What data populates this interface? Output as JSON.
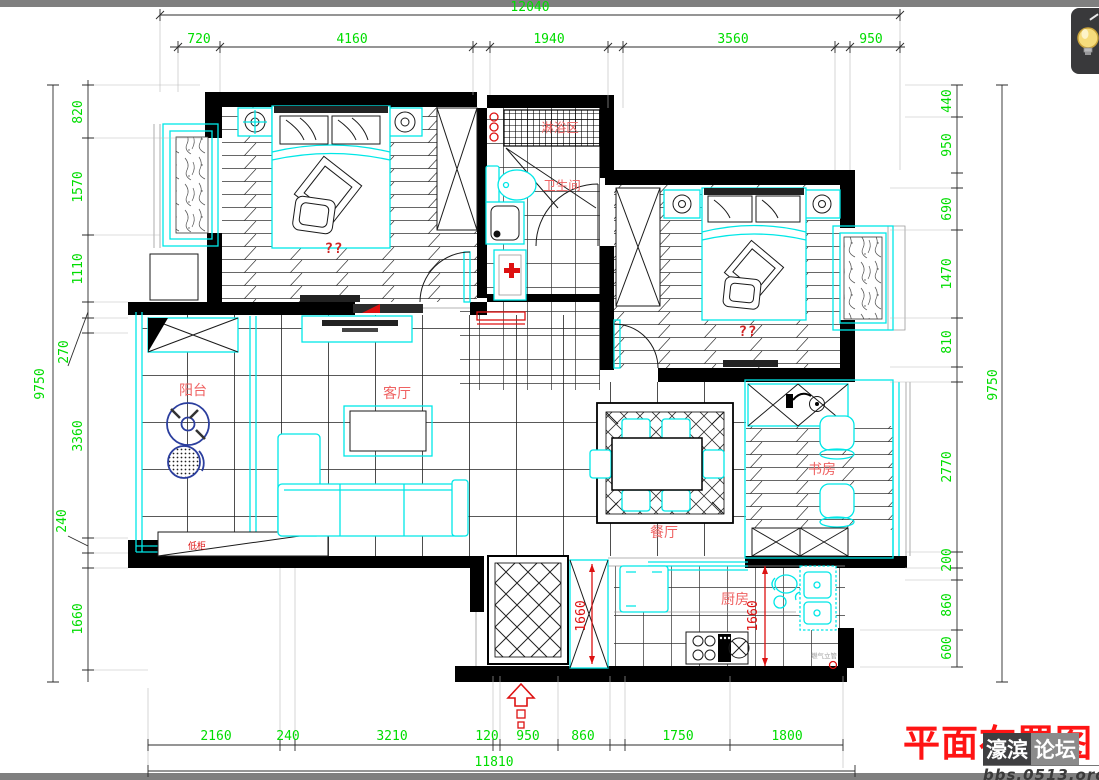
{
  "title": "平面布置图",
  "watermark": {
    "part1": "濠滨",
    "part2": "论坛",
    "url": "bbs.0513.org"
  },
  "viewer": {
    "bulb_button": "lightbulb-toggle"
  },
  "colors": {
    "dimension_text": "#00dd00",
    "fixture_cyan": "#00e7e7",
    "label_red": "#ef6262",
    "mark_red": "#dd1111",
    "title_red": "#ff1414",
    "washer_blue": "#2b3e9e"
  },
  "dims": {
    "top": {
      "overall": "12040",
      "segments": [
        "720",
        "4160",
        "1940",
        "3560",
        "950"
      ]
    },
    "bottom": {
      "overall": "11810",
      "segments": [
        "2160",
        "240",
        "3210",
        "120",
        "950",
        "860",
        "1750",
        "1800"
      ]
    },
    "left": {
      "overall": "9750",
      "segments": [
        "820",
        "1570",
        "1110",
        "270",
        "3360",
        "240",
        "1660"
      ]
    },
    "right": {
      "overall": "9750",
      "segments": [
        "440",
        "950",
        "690",
        "1470",
        "810",
        "2770",
        "200",
        "860",
        "600"
      ]
    },
    "red": {
      "entry": "1660",
      "kitchen": "1660"
    }
  },
  "rooms": {
    "shower": "淋浴区",
    "bathroom": "卫生间",
    "balcony": "阳台",
    "living": "客厅",
    "dining": "餐厅",
    "study": "书房",
    "kitchen": "厨房",
    "low_cabinet": "低柜",
    "bedroom_left": "??",
    "bedroom_right": "??",
    "gas_riser": "燃气立管"
  }
}
